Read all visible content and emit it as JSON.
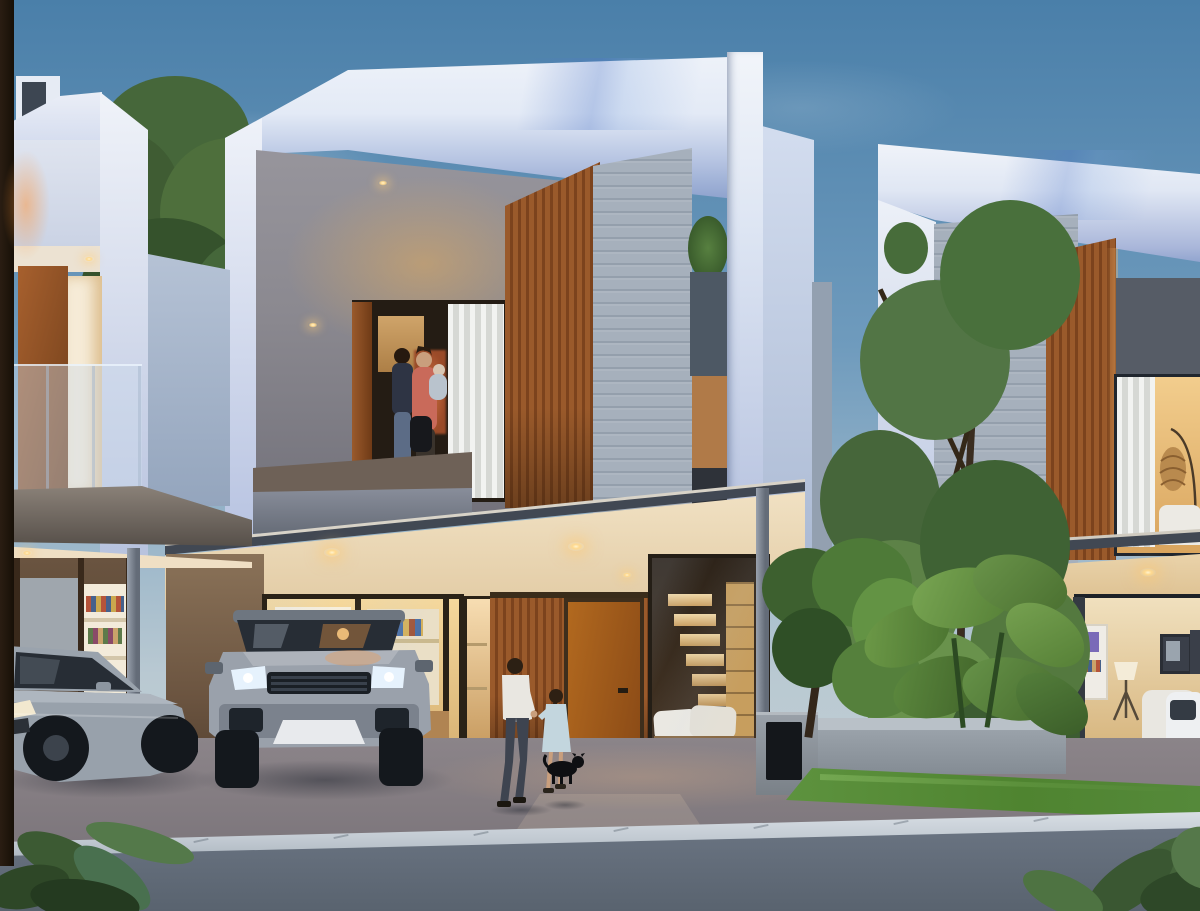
{
  "meta": {
    "title": "Modern townhouse residential exterior at dusk",
    "description": "Photorealistic architectural rendering of a row of modern two-storey townhouses at dusk with warm interior lighting, a silver SUV and a silver sedan parked in carports, a man walking with a girl and a small black dog toward the timber entry door, a family holding a baby on the centre balcony, tropical landscaping, lawn, concrete curb and asphalt street in the foreground.",
    "time_of_day": "dusk",
    "style": "3D architectural visualization"
  },
  "colors": {
    "sky-top": "#4a7fa9",
    "sky-mid": "#6f9bbd",
    "sky-horizon": "#b9c9d2",
    "cloud": "#e8f0f5",
    "white-hi": "#f1f4f9",
    "white-mid": "#dee6f4",
    "white-shade": "#aab7da",
    "soffit-blue": "#8ba0cc",
    "facade-gray": "#8e8c94",
    "warm-wash": "#dcaa62",
    "stone": "#a6b0bc",
    "wood-hi": "#9a5a2b",
    "wood-lo": "#7c431d",
    "door-wood": "#a8601f",
    "glow-hi": "#f6d99e",
    "glow-deep": "#c08445",
    "curtain-hi": "#f2f3f1",
    "glass-dark": "#272d35",
    "grass": "#55893a",
    "grass-hi": "#6fa84c",
    "tree": "#4a7038",
    "tree-hi": "#6f9e4f",
    "tree-dk": "#2f4f26",
    "leaf-fg": "#3c5a33",
    "road": "#5e6875",
    "driveway": "#877f83",
    "curb": "#d5dbe1",
    "canopy": "#414853",
    "post-gray": "#7c8592",
    "slab": "#6e6157",
    "parapet-face": "#7a8290",
    "car-silver": "#9aa3ad",
    "wheel-dark": "#14181d",
    "headlight": "#e6f2fd",
    "downlight": "#ffd98e",
    "trunk": "#241a10",
    "shirt": "#e9e7e1",
    "pants": "#3e4450",
    "dress": "#c3d6de",
    "sweater": "#2e3444",
    "coral": "#c96a5a",
    "bag": "#17181c",
    "skin": "#c99f7d"
  },
  "scene": {
    "sky": {
      "condition": "clear dusk with thin clouds"
    },
    "buildings": [
      {
        "id": "house-left",
        "features": [
          "white parapet fins and roof bulkhead",
          "upper balcony with glass railing",
          "open timber door with lit doorway",
          "lit interior shelving and grey roller blind",
          "carport with silver sedan",
          "steel post on concrete base"
        ]
      },
      {
        "id": "house-center",
        "features": [
          "white wrap-around roof blade",
          "grey feature wall washed by cove light",
          "balcony with family figures and white curtain",
          "vertical timber slat box",
          "stacked stone wall with planted niche",
          "timber entry wall and front door",
          "bookshelf window",
          "glass wall with staircase and bench cushions",
          "recessed downlights",
          "thin flat canopy on steel posts",
          "entry step"
        ]
      },
      {
        "id": "house-right",
        "features": [
          "white roof blade",
          "stacked stone wall",
          "timber window box",
          "upper window with curtain and rattan floor lamp",
          "living room with framed art, tripod lamp and white sofa",
          "timber sliding wall",
          "white SUV behind glass",
          "flat canopy with downlights",
          "planter wall",
          "black letterbox pillar",
          "grey fence"
        ]
      }
    ],
    "vehicles": [
      {
        "type": "SUV",
        "color": "silver",
        "position": "centre carport, facing viewer, headlights on"
      },
      {
        "type": "sedan",
        "color": "silver",
        "position": "left carport, three-quarter view"
      },
      {
        "type": "SUV",
        "color": "white",
        "position": "inside right house behind glass"
      }
    ],
    "figures": [
      {
        "who": "man in white shirt and dark trousers",
        "action": "walking toward entry holding child's hand"
      },
      {
        "who": "girl in light blue dress",
        "action": "walking beside man"
      },
      {
        "who": "small black dog",
        "action": "standing near girl"
      },
      {
        "who": "man, woman and baby",
        "action": "standing on centre balcony"
      }
    ],
    "vegetation": [
      "background trees behind rooflines",
      "tall tree between houses",
      "frangipani tree by fence",
      "large-leaf tropical planting in planter",
      "lawn strip",
      "foreground silhouette leaves left and right",
      "shrub in stone niche",
      "roof terrace greenery"
    ],
    "lighting": [
      "warm recessed downlights under soffits and canopies",
      "cove light washing grey feature wall",
      "warm interior glow from all rooms",
      "SUV headlights on",
      "cool dusk ambient"
    ],
    "ground": [
      "warm concrete driveway",
      "light concrete curb with joint lines",
      "asphalt street",
      "entry step and path"
    ]
  }
}
